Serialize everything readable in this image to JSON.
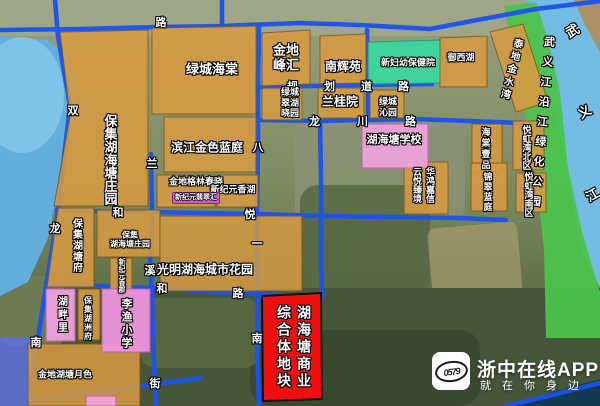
{
  "map_overlay": {
    "roads": {
      "lu_top": "路",
      "shuang": "双",
      "long_west": "龙",
      "nan_west": "南",
      "lan": "兰",
      "xi": "溪",
      "jie": "街",
      "ba": "八",
      "yi": "一",
      "nan_east": "南",
      "guihua_daolu": "规划道路",
      "longchuan_lu": "龙川路",
      "he_west": "和",
      "yue": "悦",
      "he_south": "和",
      "lu_south": "路"
    },
    "river": {
      "char1": "武",
      "char2": "义",
      "char3": "江"
    },
    "greenway": "武义江沿江绿化公园",
    "blocks": {
      "baoji_zhuangyuan_big": "保集湖海塘庄园",
      "lvcheng_haitang": "绿城海棠",
      "binjiang_jinse_lanting": "滨江金色蓝庭",
      "jindi_gelin_chunxiao": "金地格林春晓",
      "xinjiyuan_xianghu": "新纪元香湖",
      "xinjiyuan_feicuihui": "新纪元翡翠汇",
      "jindi_fenghui_l1": "金地",
      "jindi_fenghui_l2": "峰汇",
      "lvcheng_cuihu_l1": "绿城",
      "lvcheng_cuihu_l2": "翠湖",
      "lvcheng_cuihu_l3": "晓园",
      "nanhuiyuan": "南辉苑",
      "xinfuyou": "新妇幼保健院",
      "yuxihu": "御西湖",
      "taidi_jinshuiwan": "泰地金水湾",
      "languiyuan": "兰桂院",
      "lvcheng_qinyuan_l1": "绿城",
      "lvcheng_qinyuan_l2": "沁园",
      "huhaitang_school": "湖海塘学校",
      "haitang_yipin": "海棠壹品",
      "yuehongwan_bei": "悦虹湾北区",
      "yuehongwan_nan": "悦虹湾南区",
      "huahong_jiaxin": "华鸿嘉信",
      "yunyue_zhenjing": "云悦臻境",
      "jincui_lanting": "锦翠蓝庭",
      "baoji_hutangfu": "保集湖塘府",
      "baoji_small_l1": "保集",
      "baoji_small_l2": "湖海塘庄园",
      "xinjiyuan_xiangjun": "新纪元香郡",
      "guangming_huayuan": "光明湖海城市花园",
      "hupanli": "湖畔里",
      "baoji_huzhoufu": "保集湖洲府",
      "liyu_xiaoxue": "李渔小学",
      "jindi_yuese": "金地湖塘月色",
      "plot_col_right": "湖海塘商业",
      "plot_col_left": "综合体地块"
    },
    "colors": {
      "road_blue": "#1b53ee",
      "parcel_orange": "#d79b42",
      "parcel_pink": "#f2a2de",
      "parcel_teal": "#3bd8a2",
      "greenway_green": "#4cc44c",
      "highlight_red": "#ee1010",
      "water_blue": "#6fb9e2"
    }
  },
  "watermark": {
    "logo_text": "0579",
    "app_name": "浙中在线APP",
    "tagline": "就在你身边"
  }
}
